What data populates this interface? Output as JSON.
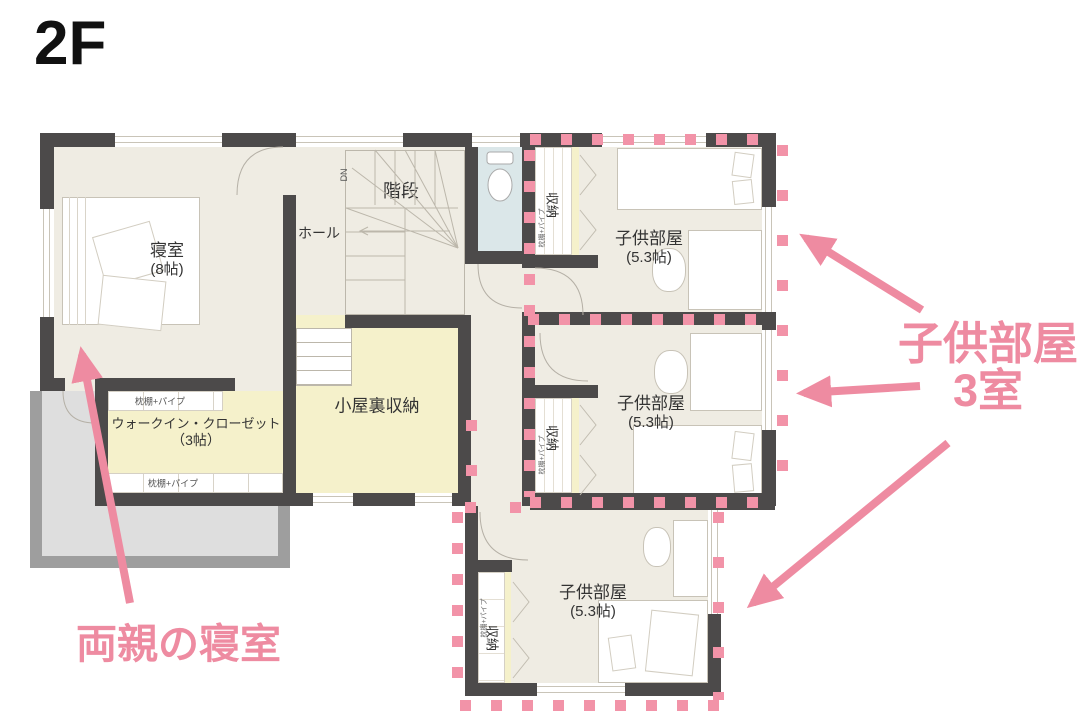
{
  "title": "2F",
  "colors": {
    "wall": "#4c4a4a",
    "floor": "#efece3",
    "annex_yellow": "#f5f1cb",
    "wc_blue": "#dbe7e9",
    "balcony_gray": "#dedede",
    "accent_pink": "#ee8ba1"
  },
  "rooms": {
    "bedroom": {
      "label": "寝室",
      "size": "(8帖)"
    },
    "hall": {
      "label": "ホール"
    },
    "stairs": {
      "label": "階段",
      "marker": "DN"
    },
    "wc": {
      "label": "WC"
    },
    "attic": {
      "label": "小屋裏収納"
    },
    "wic": {
      "label": "ウォークイン・クローゼット",
      "size": "（3帖）",
      "shelf_top": "枕棚+パイプ",
      "shelf_bottom": "枕棚+パイプ"
    },
    "kids": [
      {
        "label": "子供部屋",
        "size": "(5.3帖)",
        "closet": "収納",
        "closet_shelf": "枕棚+パイプ"
      },
      {
        "label": "子供部屋",
        "size": "(5.3帖)",
        "closet": "収納",
        "closet_shelf": "枕棚+パイプ"
      },
      {
        "label": "子供部屋",
        "size": "(5.3帖)",
        "closet": "収納",
        "closet_shelf": "枕棚+パイプ"
      }
    ]
  },
  "annotations": {
    "kids_note": {
      "line1": "子供部屋",
      "line2": "3室"
    },
    "parents_note": "両親の寝室"
  }
}
